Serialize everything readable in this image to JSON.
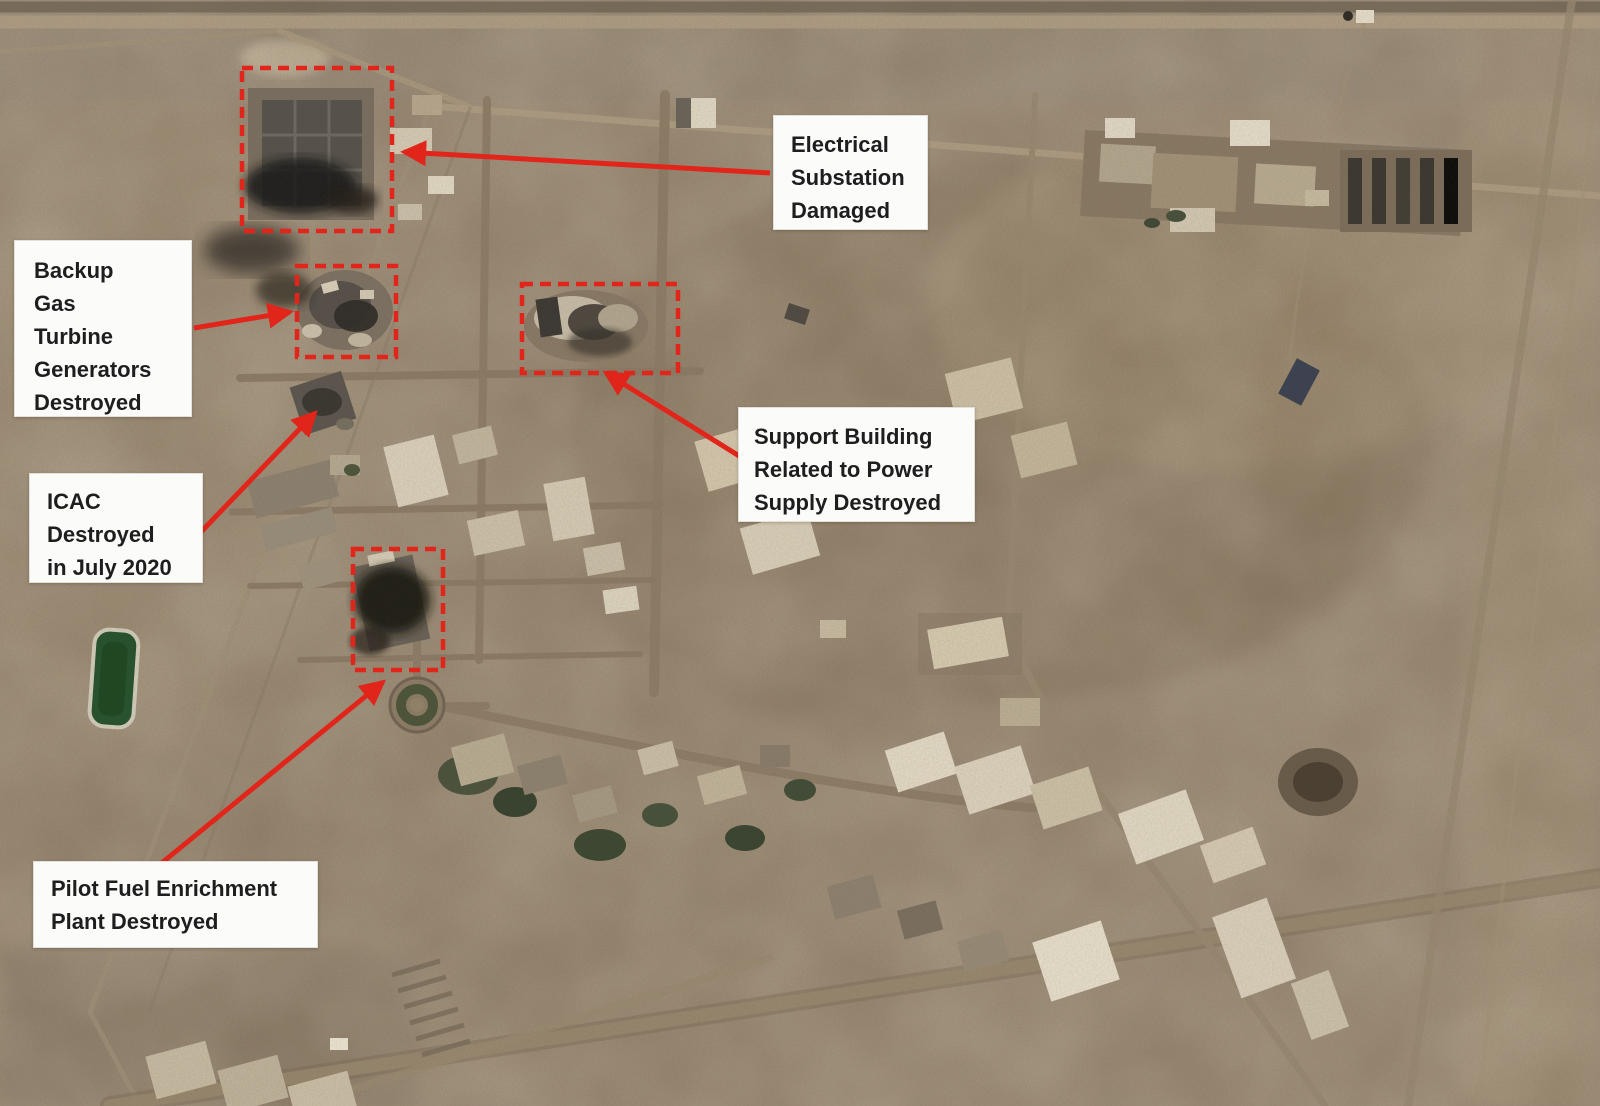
{
  "annotations": {
    "electrical_substation": {
      "label": "Electrical\nSubstation\nDamaged"
    },
    "backup_gas_turbine": {
      "label": "Backup\nGas\nTurbine\nGenerators\nDestroyed"
    },
    "icac": {
      "label": "ICAC\nDestroyed\nin July 2020"
    },
    "support_building": {
      "label": "Support Building\nRelated to Power\nSupply Destroyed"
    },
    "pilot_fuel_plant": {
      "label": "Pilot Fuel Enrichment\nPlant Destroyed"
    }
  },
  "colors": {
    "annotation_red": "#e1251b",
    "label_background": "#fbfbfa",
    "label_text": "#1e1e1e",
    "desert_base": "#92806a",
    "pond_green": "#24522b"
  }
}
